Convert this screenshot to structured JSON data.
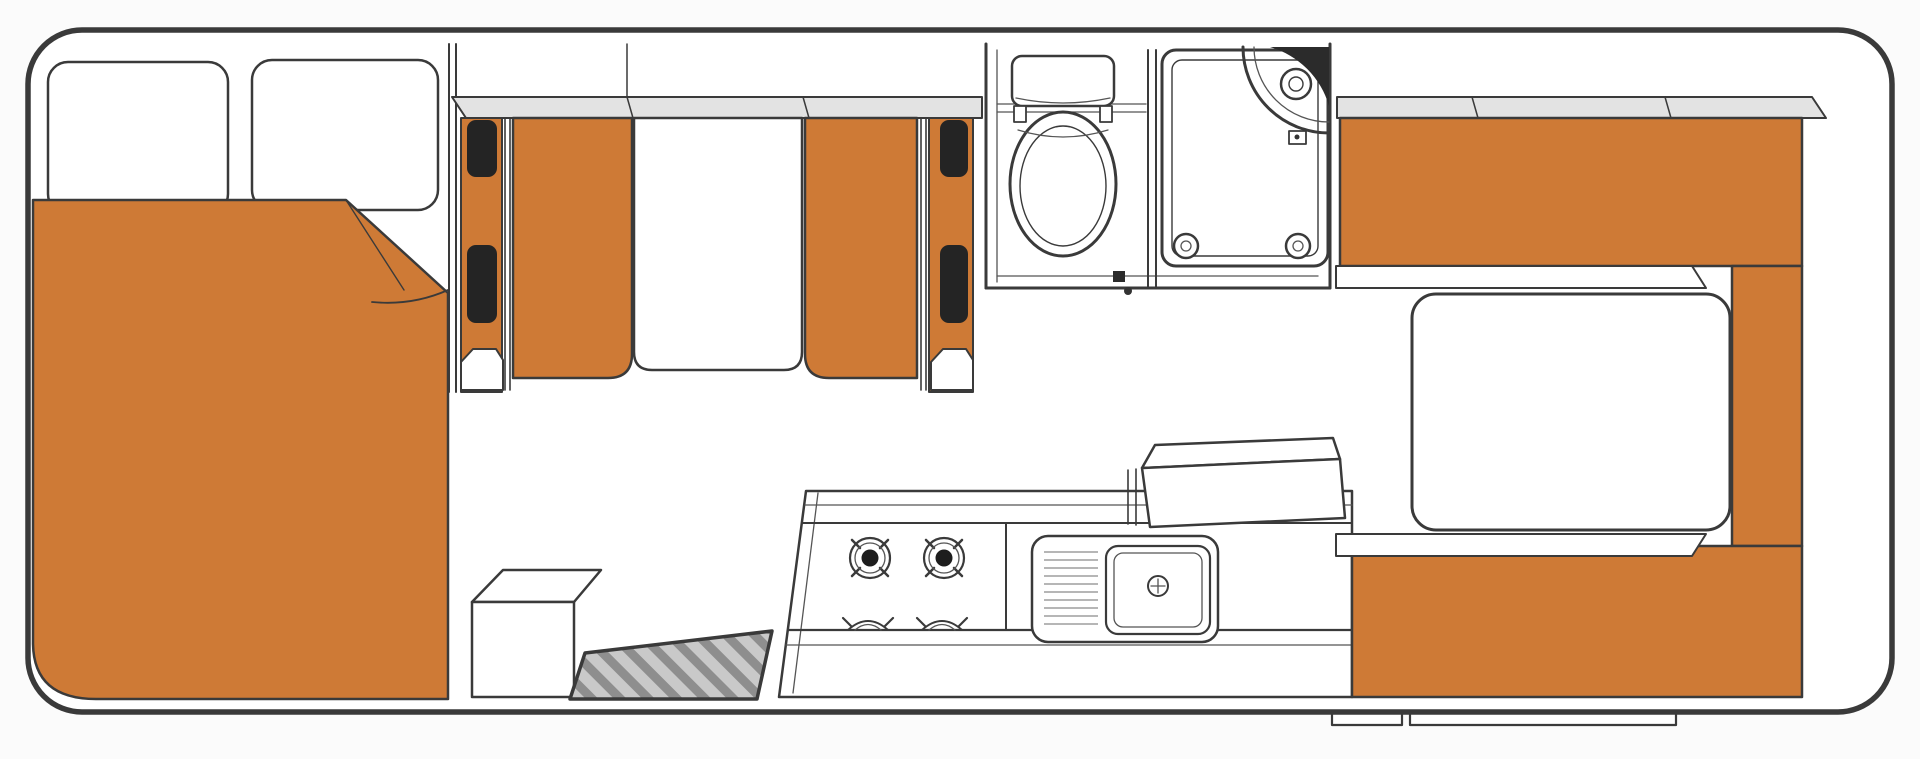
{
  "diagram": {
    "type": "floorplan",
    "subject": "motorhome-campervan-floor-plan",
    "orientation": "side-view-top-down, cab at left, rear lounge at right",
    "colors": {
      "background": "#fbfbfb",
      "body_fill": "#ffffff",
      "outline": "#2e2e2e",
      "line": "#3a3a3a",
      "upholstery_orange": "#CE7A36",
      "overhead_cabinet_gray": "#E3E3E3",
      "seatbelt_black": "#242424",
      "mat_base": "#C9C9C9",
      "mat_stripe": "#8E8E8E"
    },
    "rooms": [
      {
        "name": "cab-over-double-bed",
        "position": "front-left"
      },
      {
        "name": "dinette-with-table-and-belted-seats",
        "position": "mid-front"
      },
      {
        "name": "bathroom-toilet-and-shower",
        "position": "mid-top"
      },
      {
        "name": "kitchen-galley",
        "position": "mid-bottom"
      },
      {
        "name": "rear-u-shaped-lounge-with-table",
        "position": "right"
      }
    ],
    "furniture": [
      "double-bed-with-two-pillows-and-folded-duvet",
      "forward-facing-belted-dinette-seat",
      "rear-facing-belted-dinette-seat",
      "dinette-table",
      "overhead-lockers-front",
      "toilet-with-cistern",
      "shower-cubicle-with-corner-shower-unit",
      "four-burner-gas-hob",
      "sink-with-drainer",
      "bench-cabinet-box",
      "entry-step-box",
      "entry-door-mat",
      "rear-bench-top",
      "rear-bench-right",
      "rear-bench-bottom",
      "rear-table",
      "overhead-lockers-rear",
      "exterior-step-small",
      "exterior-step-wide"
    ]
  }
}
